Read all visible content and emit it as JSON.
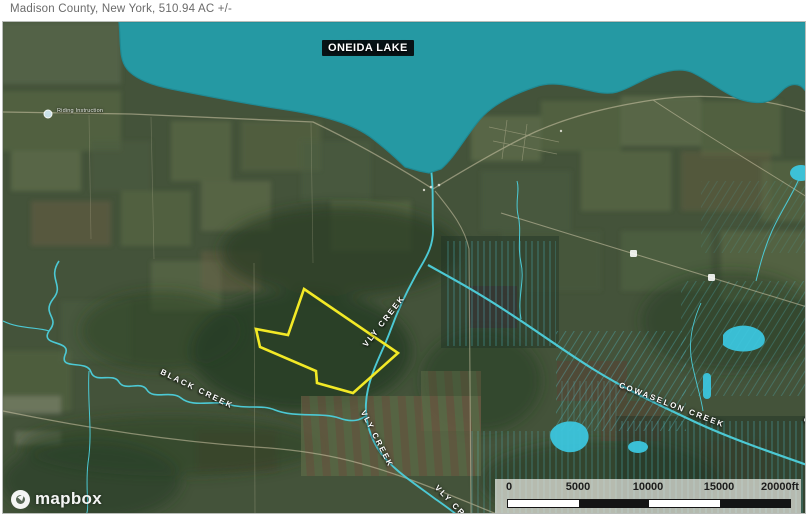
{
  "title_bar": {
    "text": "Madison County, New York, 510.94 AC +/-"
  },
  "map": {
    "lake_label": "ONEIDA LAKE",
    "creek_labels": {
      "black": "BLACK CREEK",
      "vly_upper": "VLY CREEK",
      "vly_lower": "VLY CREEK",
      "vly_bottom": "VLY CREEK",
      "cowaselon": "COWASELON CREEK",
      "cowaselon_edge": "COWASELON CREEK"
    },
    "poi_label": "Riding Instruction",
    "attribution_label": "mapbox",
    "scale_bar": {
      "labels": [
        "0",
        "5000",
        "10000",
        "15000",
        "20000ft"
      ]
    },
    "colors": {
      "water": "#2599a3",
      "creek": "#4cc9d4",
      "boundary": "#f2e926",
      "pond": "#3cc6de"
    }
  }
}
